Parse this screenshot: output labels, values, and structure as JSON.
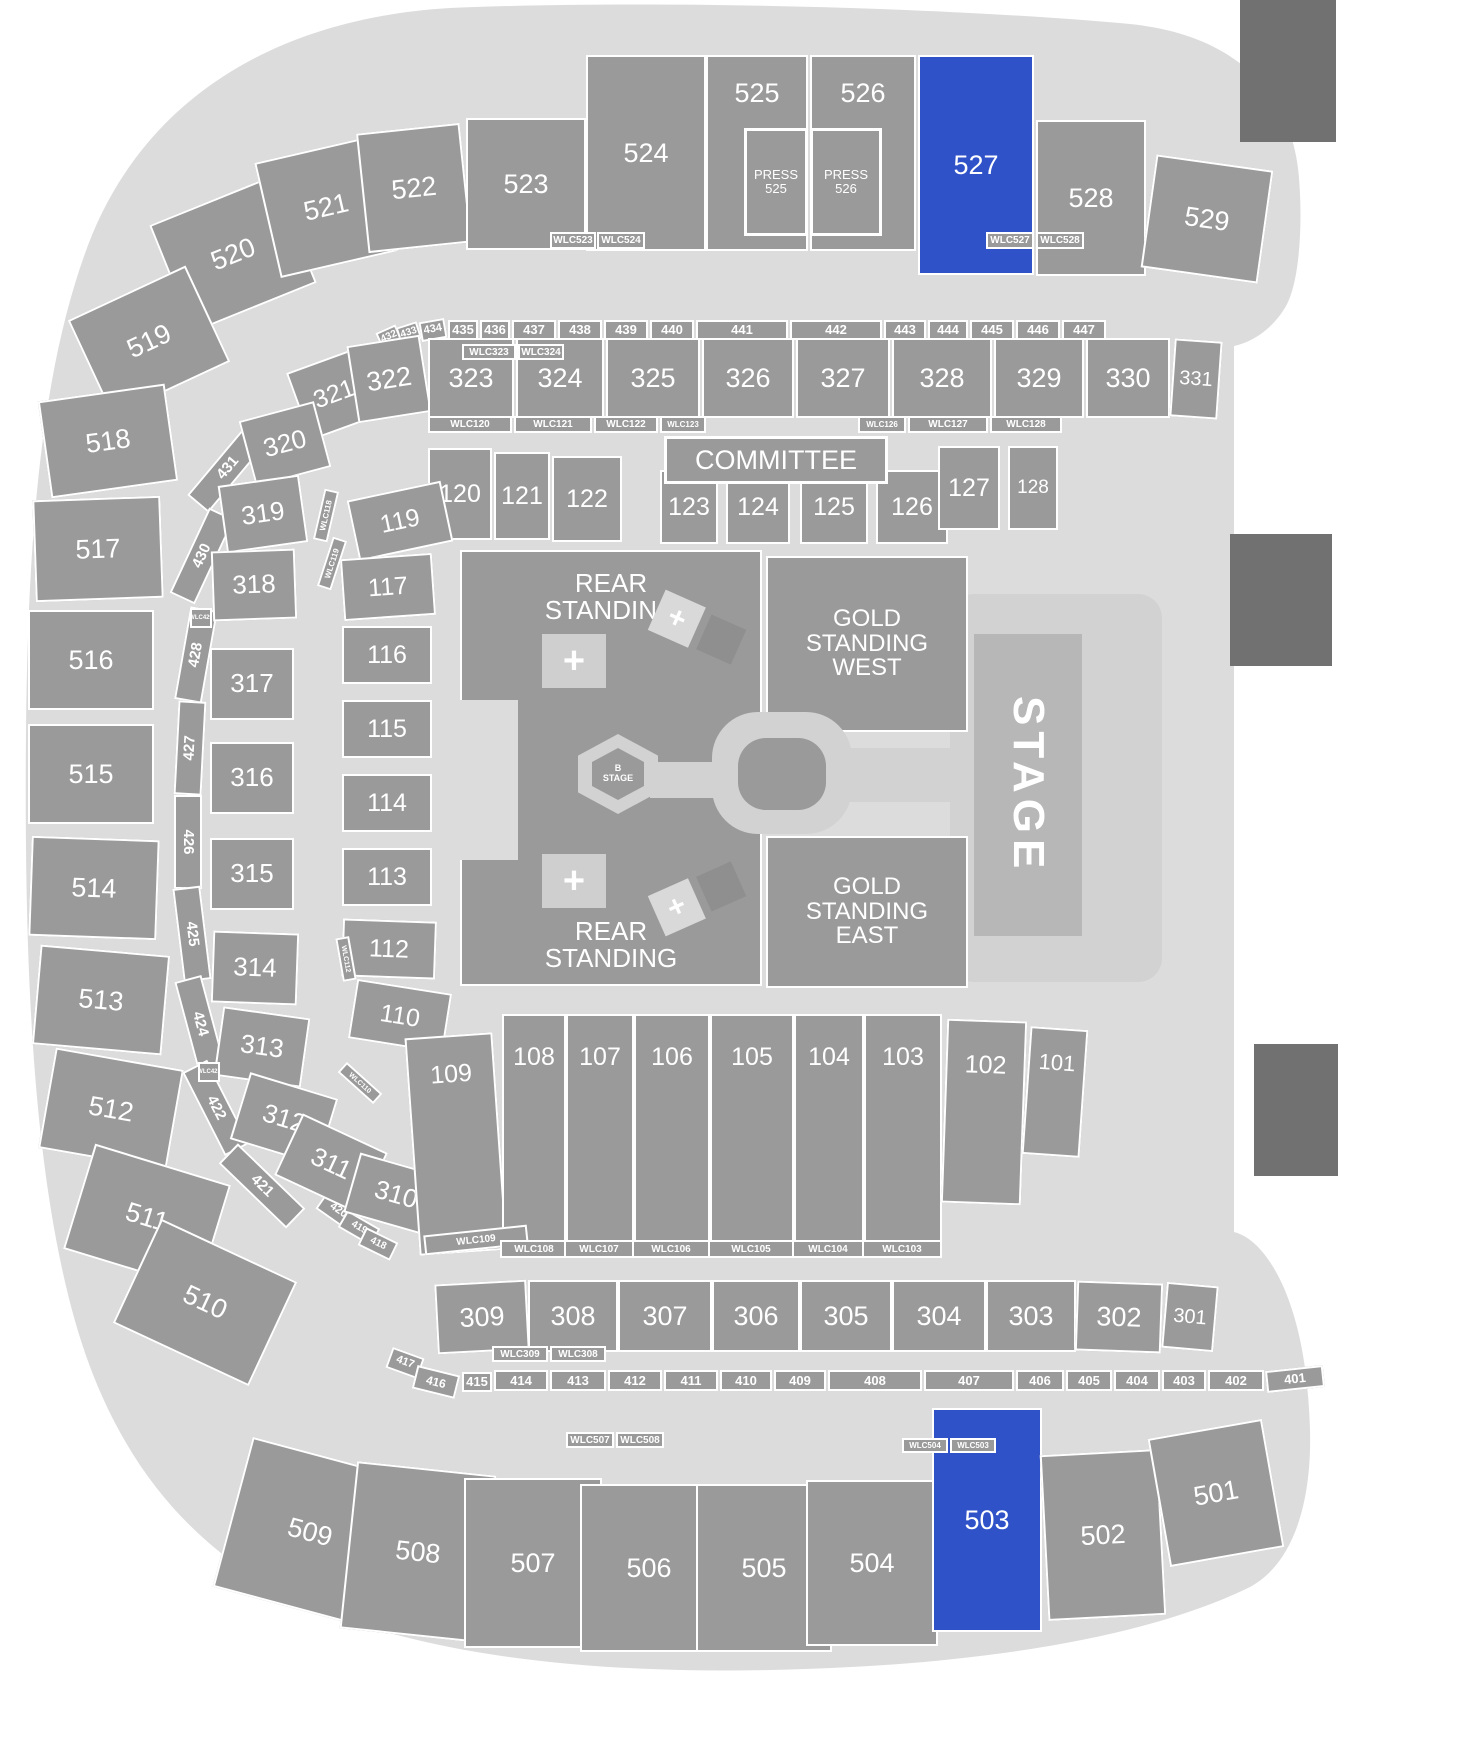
{
  "colors": {
    "selected": "#2f52c9",
    "section": "#9a9a9a",
    "bowl": "#dcdcdc",
    "walkway": "#d2d2d2",
    "stage": "#b7b7b7",
    "screen": "#717171",
    "label": "#ffffff"
  },
  "selected_sections": [
    "527",
    "503"
  ],
  "center": {
    "committee": "COMMITTEE",
    "rear_standing": "REAR\nSTANDING",
    "gold_west": "GOLD\nSTANDING\nWEST",
    "gold_east": "GOLD\nSTANDING\nEAST",
    "b_stage": "B\nSTAGE",
    "stage": "STAGE",
    "plus": "+"
  },
  "S": {
    "s501": "501",
    "s502": "502",
    "s503": "503",
    "s504": "504",
    "s505": "505",
    "s506": "506",
    "s507": "507",
    "s508": "508",
    "s509": "509",
    "s510": "510",
    "s511": "511",
    "s512": "512",
    "s513": "513",
    "s514": "514",
    "s515": "515",
    "s516": "516",
    "s517": "517",
    "s518": "518",
    "s519": "519",
    "s520": "520",
    "s521": "521",
    "s522": "522",
    "s523": "523",
    "s524": "524",
    "s525": "525",
    "s526": "526",
    "s527": "527",
    "s528": "528",
    "s529": "529",
    "press525": "PRESS\n525",
    "press526": "PRESS\n526",
    "s301": "301",
    "s302": "302",
    "s303": "303",
    "s304": "304",
    "s305": "305",
    "s306": "306",
    "s307": "307",
    "s308": "308",
    "s309": "309",
    "s310": "310",
    "s311": "311",
    "s312": "312",
    "s313": "313",
    "s314": "314",
    "s315": "315",
    "s316": "316",
    "s317": "317",
    "s318": "318",
    "s319": "319",
    "s320": "320",
    "s321": "321",
    "s322": "322",
    "s323": "323",
    "s324": "324",
    "s325": "325",
    "s326": "326",
    "s327": "327",
    "s328": "328",
    "s329": "329",
    "s330": "330",
    "s331": "331",
    "s401": "401",
    "s402": "402",
    "s403": "403",
    "s404": "404",
    "s405": "405",
    "s406": "406",
    "s407": "407",
    "s408": "408",
    "s409": "409",
    "s410": "410",
    "s411": "411",
    "s412": "412",
    "s413": "413",
    "s414": "414",
    "s415": "415",
    "s416": "416",
    "s417": "417",
    "s418": "418",
    "s419": "419",
    "s420": "420",
    "s421": "421",
    "s422": "422",
    "s424": "424",
    "s425": "425",
    "s426": "426",
    "s427": "427",
    "s428": "428",
    "s430": "430",
    "s431": "431",
    "s432": "432",
    "s433": "433",
    "s434": "434",
    "s435": "435",
    "s436": "436",
    "s437": "437",
    "s438": "438",
    "s439": "439",
    "s440": "440",
    "s441": "441",
    "s442": "442",
    "s443": "443",
    "s444": "444",
    "s445": "445",
    "s446": "446",
    "s447": "447",
    "s101": "101",
    "s102": "102",
    "s103": "103",
    "s104": "104",
    "s105": "105",
    "s106": "106",
    "s107": "107",
    "s108": "108",
    "s109": "109",
    "s110": "110",
    "s112": "112",
    "s113": "113",
    "s114": "114",
    "s115": "115",
    "s116": "116",
    "s117": "117",
    "s119": "119",
    "s120": "120",
    "s121": "121",
    "s122": "122",
    "s123": "123",
    "s124": "124",
    "s125": "125",
    "s126": "126",
    "s127": "127",
    "s128": "128",
    "wlc103": "WLC103",
    "wlc104": "WLC104",
    "wlc105": "WLC105",
    "wlc106": "WLC106",
    "wlc107": "WLC107",
    "wlc108": "WLC108",
    "wlc109": "WLC109",
    "wlc110": "WLC110",
    "wlc112": "WLC112",
    "wlc118": "WLC118",
    "wlc119": "WLC119",
    "wlc120": "WLC120",
    "wlc121": "WLC121",
    "wlc122": "WLC122",
    "wlc123": "WLC123",
    "wlc126": "WLC126",
    "wlc127": "WLC127",
    "wlc128": "WLC128",
    "wlc308": "WLC308",
    "wlc309": "WLC309",
    "wlc323": "WLC323",
    "wlc324": "WLC324",
    "wlc423": "WLC423",
    "wlc429": "WLC429",
    "wlc503": "WLC503",
    "wlc504": "WLC504",
    "wlc507": "WLC507",
    "wlc508": "WLC508",
    "wlc523": "WLC523",
    "wlc524": "WLC524",
    "wlc527": "WLC527",
    "wlc528": "WLC528"
  }
}
